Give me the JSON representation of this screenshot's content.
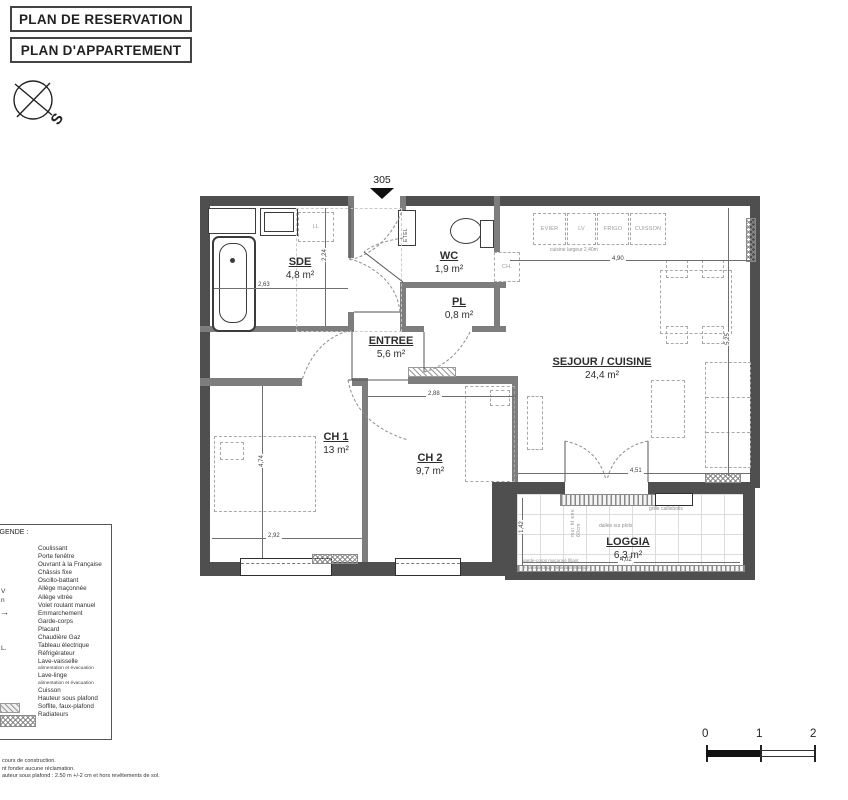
{
  "titles": {
    "box1": "PLAN DE RESERVATION",
    "box2": "PLAN D'APPARTEMENT"
  },
  "compass": {
    "south": "S"
  },
  "plan": {
    "unit": "305",
    "rooms": {
      "sde": {
        "name": "SDE",
        "area": "4,8 m²"
      },
      "wc": {
        "name": "WC",
        "area": "1,9 m²"
      },
      "pl": {
        "name": "PL",
        "area": "0,8 m²"
      },
      "entree": {
        "name": "ENTREE",
        "area": "5,6 m²"
      },
      "sejour": {
        "name": "SEJOUR / CUISINE",
        "area": "24,4 m²"
      },
      "ch1": {
        "name": "CH 1",
        "area": "13 m²"
      },
      "ch2": {
        "name": "CH 2",
        "area": "9,7 m²"
      },
      "loggia": {
        "name": "LOGGIA",
        "area": "6,3 m²"
      }
    },
    "kitchen": {
      "evier": "EVIER",
      "lv": "LV",
      "frigo": "FRIGO",
      "cuisson": "CUISSON",
      "note": "cuisine largeur 2,40m"
    },
    "equipment": {
      "ll": "LL",
      "etel": "ETEL",
      "boiler": "CH."
    },
    "windows": {
      "vre": "VRe",
      "am20": "AM 20cm",
      "am90": "AM 90cm"
    },
    "loggia_notes": {
      "dalles": "dalles sur plots",
      "grille": "grille caillebotis",
      "garde1": "garde-corps maçonné fillant",
      "garde2": "+ barreaudage vertical metalique",
      "mur": "mur ht env. 60cm"
    },
    "dims": {
      "sde_w": "2,63",
      "sde_h": "2,24",
      "kitchen_w": "4,90",
      "sejour_h": "5,25",
      "bay_w": "4,51",
      "ch1_h": "4,74",
      "ch1_w": "2,92",
      "ch2_w": "2,88",
      "loggia_w": "4,02",
      "loggia_h": "1,42"
    }
  },
  "legend": {
    "title": "LEGENDE :",
    "items": [
      "Coulissant",
      "Porte fenêtre",
      "Ouvrant à la Française",
      "Châssis fixe",
      "Oscillo-battant",
      "Allège maçonnée",
      "Allège vitrée",
      "Volet roulant manuel",
      "Emmarchement",
      "Garde-corps",
      "Placard",
      "Chaudière Gaz",
      "Tableau électrique",
      "Réfrigérateur",
      "Lave-vaisselle",
      "alimentation et évacuation",
      "Lave-linge",
      "alimentation et évacuation",
      "Cuisson",
      "Hauteur sous plafond",
      "Soffite, faux-plafond",
      "Radiateurs"
    ],
    "fragments": {
      "f1": "V",
      "f2": "n",
      "f3": "L."
    }
  },
  "footer": {
    "notes": [
      "cours de construction.",
      "nt fonder aucune réclamation.",
      "auteur sous plafond : 2.50 m +/-2 cm et hors revêtements de sol."
    ],
    "scale": {
      "n0": "0",
      "n1": "1",
      "n2": "2"
    }
  }
}
